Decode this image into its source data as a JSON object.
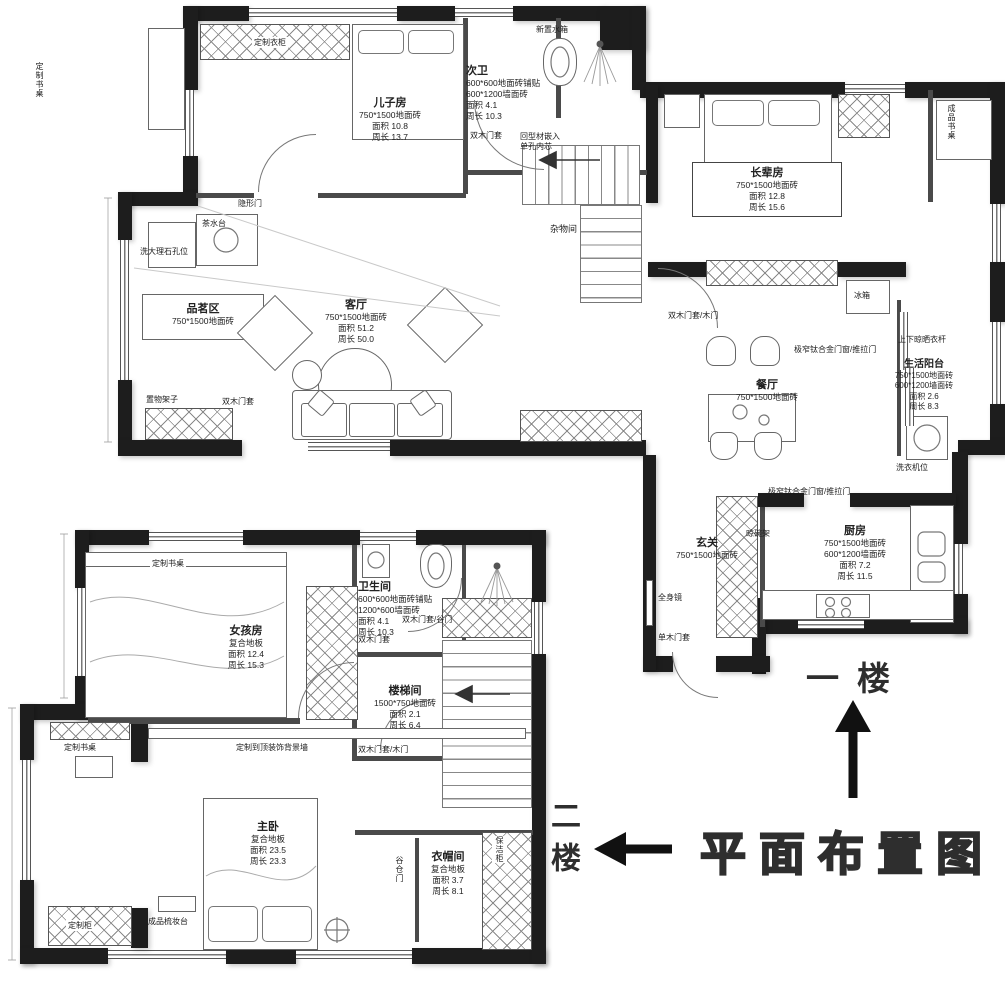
{
  "title": "平面布置图",
  "floor_labels": {
    "first": "一楼",
    "second": "二楼"
  },
  "rooms": {
    "son_room": {
      "name": "儿子房",
      "spec1": "750*1500地面砖",
      "area": "面积 10.8",
      "perimeter": "周长 13.7"
    },
    "second_bath": {
      "name": "次卫",
      "spec1": "600*600地面砖铺贴",
      "spec2": "600*1200墙面砖",
      "area": "面积 4.1",
      "perimeter": "周长 10.3"
    },
    "elder_room": {
      "name": "长辈房",
      "spec1": "750*1500地面砖",
      "area": "面积 12.8",
      "perimeter": "周长 15.6"
    },
    "living": {
      "name": "客厅",
      "spec1": "750*1500地面砖",
      "area": "面积 51.2",
      "perimeter": "周长 50.0"
    },
    "tea_area": {
      "name": "品茗区",
      "spec1": "750*1500地面砖"
    },
    "dining": {
      "name": "餐厅",
      "spec1": "750*1500地面砖"
    },
    "balcony": {
      "name": "生活阳台",
      "spec1": "750*1500地面砖",
      "spec2": "600*1200墙面砖",
      "area": "面积 2.6",
      "perimeter": "周长 8.3"
    },
    "kitchen": {
      "name": "厨房",
      "spec1": "750*1500地面砖",
      "spec2": "600*1200墙面砖",
      "area": "面积 7.2",
      "perimeter": "周长 11.5"
    },
    "entry": {
      "name": "玄关",
      "spec1": "750*1500地面砖"
    },
    "girl_room": {
      "name": "女孩房",
      "spec1": "复合地板",
      "area": "面积 12.4",
      "perimeter": "周长 15.3"
    },
    "bathroom2": {
      "name": "卫生间",
      "spec1": "600*600地面砖铺贴",
      "spec2": "1200*600墙面砖",
      "area": "面积 4.1",
      "perimeter": "周长 10.3"
    },
    "stairwell": {
      "name": "楼梯间",
      "spec1": "1500*750地面砖",
      "area": "面积 2.1",
      "perimeter": "周长 6.4"
    },
    "master": {
      "name": "主卧",
      "spec1": "复合地板",
      "area": "面积 23.5",
      "perimeter": "周长 23.3"
    },
    "closet": {
      "name": "衣帽间",
      "spec1": "复合地板",
      "area": "面积 3.7",
      "perimeter": "周长 8.1"
    }
  },
  "annotations": {
    "custom_desk_1f": "定制书桌",
    "custom_wardrobe_1f": "定制衣柜",
    "cistern": "新置水箱",
    "profile_line1": "回型材嵌入",
    "profile_line2": "单孔内芯",
    "bath_casing_1f": "双木门套",
    "hidden_door": "隐形门",
    "tea_counter": "茶水台",
    "marble_hole": "洗大理石孔位",
    "shelf": "置物架子",
    "living_casing": "双木门套",
    "sundry": "杂物间",
    "elder_door": "双木门套/木门",
    "finished_desk": "成品书桌",
    "fridge": "冰箱",
    "drying_rod": "上下晾晒衣杆",
    "balcony_door": "极窄钛合金门窗/推拉门",
    "washer": "洗衣机位",
    "kitchen_door": "极窄钛合金门窗/推拉门",
    "dish_rack": "晾碗架",
    "full_mirror": "全身镜",
    "single_casing": "单木门套",
    "girl_desk": "定制书桌",
    "bath_barn_2f": "双木门套/谷门",
    "bath_casing_2f": "双木门套",
    "stair_door_2f": "双木门套/木门",
    "master_desk": "定制书桌",
    "bg_wall": "定制到顶装饰背景墙",
    "dresser": "成品梳妆台",
    "custom_cabinet": "定制柜",
    "barn_door": "谷仓门",
    "cleaning_cabinet": "保洁柜"
  },
  "colors": {
    "wall": "#1d1d1d",
    "line": "#666666",
    "text": "#222222"
  }
}
